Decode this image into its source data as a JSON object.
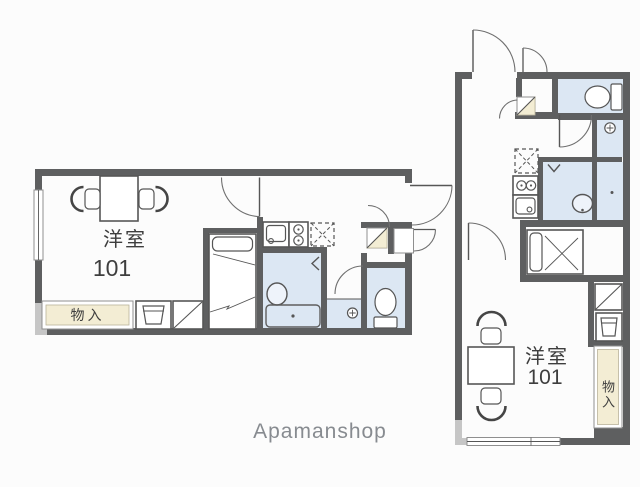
{
  "watermark": {
    "label": "Apamanshop"
  },
  "colors": {
    "bg": "#fcfcfc",
    "wall": "#5e5f60",
    "corner": "#c6c6c6",
    "water": "#dce7f3",
    "beige": "#f3edd4",
    "line": "#565656",
    "door": "#6f6f6f",
    "text": "#3e3e3e",
    "watermark": "#878b90"
  },
  "plans": {
    "left": {
      "orientation": "horizontal",
      "room_label": "洋室",
      "room_number": "101",
      "storage_label": "物入",
      "fixtures": [
        "table",
        "chairs",
        "bed",
        "sink",
        "stove",
        "fridge-space",
        "bathtub",
        "washbasin",
        "toilet",
        "washer-pan",
        "laundry-faucet",
        "shoe-shelf",
        "window",
        "entrance-door"
      ]
    },
    "right": {
      "orientation": "vertical",
      "room_label": "洋室",
      "room_number": "101",
      "storage_label": "物入",
      "fixtures": [
        "table",
        "chairs",
        "bed",
        "sink",
        "stove",
        "fridge-space",
        "bathtub",
        "washbasin",
        "toilet",
        "washer-pan",
        "laundry-faucet",
        "shoe-shelf",
        "window",
        "entrance-door"
      ]
    }
  }
}
